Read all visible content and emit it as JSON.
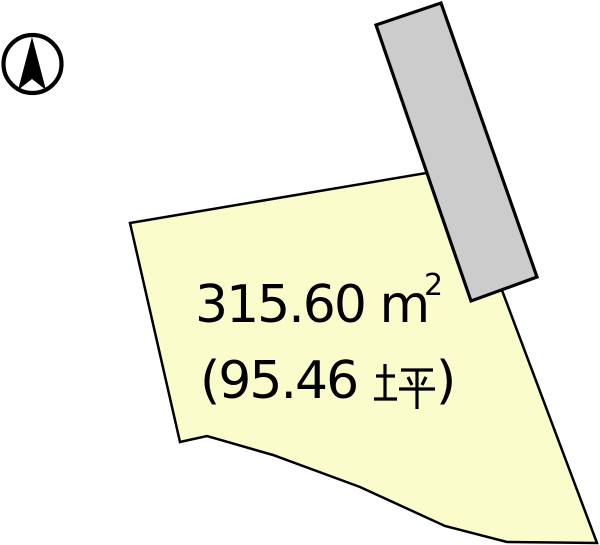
{
  "diagram": {
    "kind": "land-plot-survey-diagram",
    "background": "#FFFFFF",
    "outline_color": "#000000",
    "compass": {
      "icon": "north-arrow"
    },
    "road": {
      "fill": "#CCCCCC"
    },
    "plot": {
      "fill": "#FBFCCB",
      "area_sqm_full": "315.60 ㎡",
      "area_sqm_main": "315.60 m",
      "area_sqm_sup": "2",
      "area_tsubo_full": "(95.46 坪)",
      "area_tsubo_open": "(95.46",
      "area_tsubo_kanji": "坪",
      "area_tsubo_close": ")"
    }
  }
}
